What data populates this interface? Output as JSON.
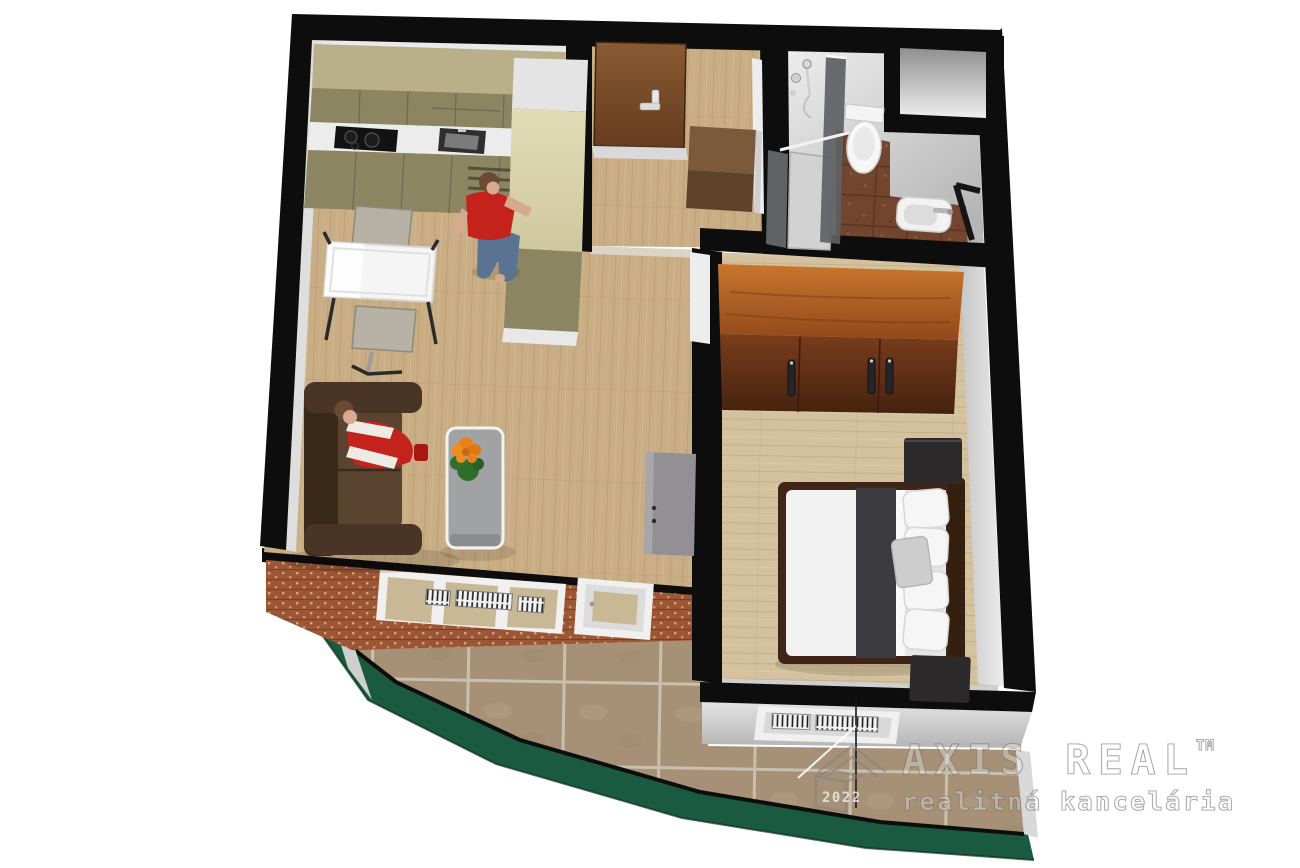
{
  "watermark": {
    "brand": "AXIS REAL",
    "trademark": "TM",
    "tagline": "realitná kancelária",
    "year": "2022"
  },
  "scene": {
    "type": "3d-floor-plan-render",
    "view": "top-down axonometric",
    "rooms": [
      {
        "name": "living-room-with-kitchen",
        "furniture": [
          "kitchen-upper-cabinets",
          "cooktop",
          "sink",
          "kitchen-lower-cabinets",
          "tall-cabinet",
          "dining-table",
          "chair",
          "chair",
          "sofa",
          "coffee-table",
          "flower",
          "sideboard"
        ],
        "people": [
          "woman-standing-red-top",
          "woman-sitting-on-sofa"
        ]
      },
      {
        "name": "entrance-hall",
        "furniture": [
          "entrance-door",
          "shoe-cabinet"
        ]
      },
      {
        "name": "bathroom",
        "furniture": [
          "shower",
          "glass-partition",
          "toilet",
          "washbasin",
          "dark-frame"
        ]
      },
      {
        "name": "bedroom",
        "furniture": [
          "wardrobe",
          "double-bed",
          "nightstand",
          "nightstand",
          "window-radiator"
        ]
      },
      {
        "name": "balcony",
        "furniture": []
      },
      {
        "name": "shaft-niche",
        "furniture": []
      }
    ]
  },
  "colors": {
    "background": "#ffffff",
    "wall_cut": "#0d0d0d",
    "wall_face_light": "#e9e9e9",
    "wall_face_mid": "#cfcfcf",
    "floor_wood_living": "#c9ad84",
    "floor_wood_bedroom": "#d4c19d",
    "floor_tile_bath": "#74452e",
    "balcony_tile": "#a79176",
    "brick": "#9b5635",
    "parapet_green": "#1a5a40",
    "kitchen_upper": "#b9b089",
    "kitchen_front": "#8b8562",
    "kitchen_tall": "#d8d2ab",
    "counter": "#ececec",
    "hob": "#121212",
    "sofa": "#4a3425",
    "sofa_dark": "#3a2818",
    "table_white": "#f5f5f5",
    "chair": "#b6b1a4",
    "coffee_table": "#a0a2a4",
    "flower_orange": "#e8821a",
    "flower_leaf": "#2f6d2b",
    "sideboard": "#929094",
    "door_entry": "#7a4a28",
    "door_handle": "#e8e8e8",
    "shoe_cabinet_top": "#7b5a3c",
    "shoe_cabinet_front": "#5e422a",
    "wardrobe_top": "#b4601f",
    "wardrobe_front": "#6b3413",
    "bed_frame": "#3f2417",
    "bedding": "#f1f1f1",
    "bed_runner": "#3b3b40",
    "pillow_gray": "#cdcdcd",
    "nightstand": "#2c2a2b",
    "person_red": "#c3231c",
    "person_jeans": "#5b7392",
    "person_skin": "#d9a98f",
    "person_hair": "#6b4a33",
    "chrome": "#c9c9c9"
  }
}
